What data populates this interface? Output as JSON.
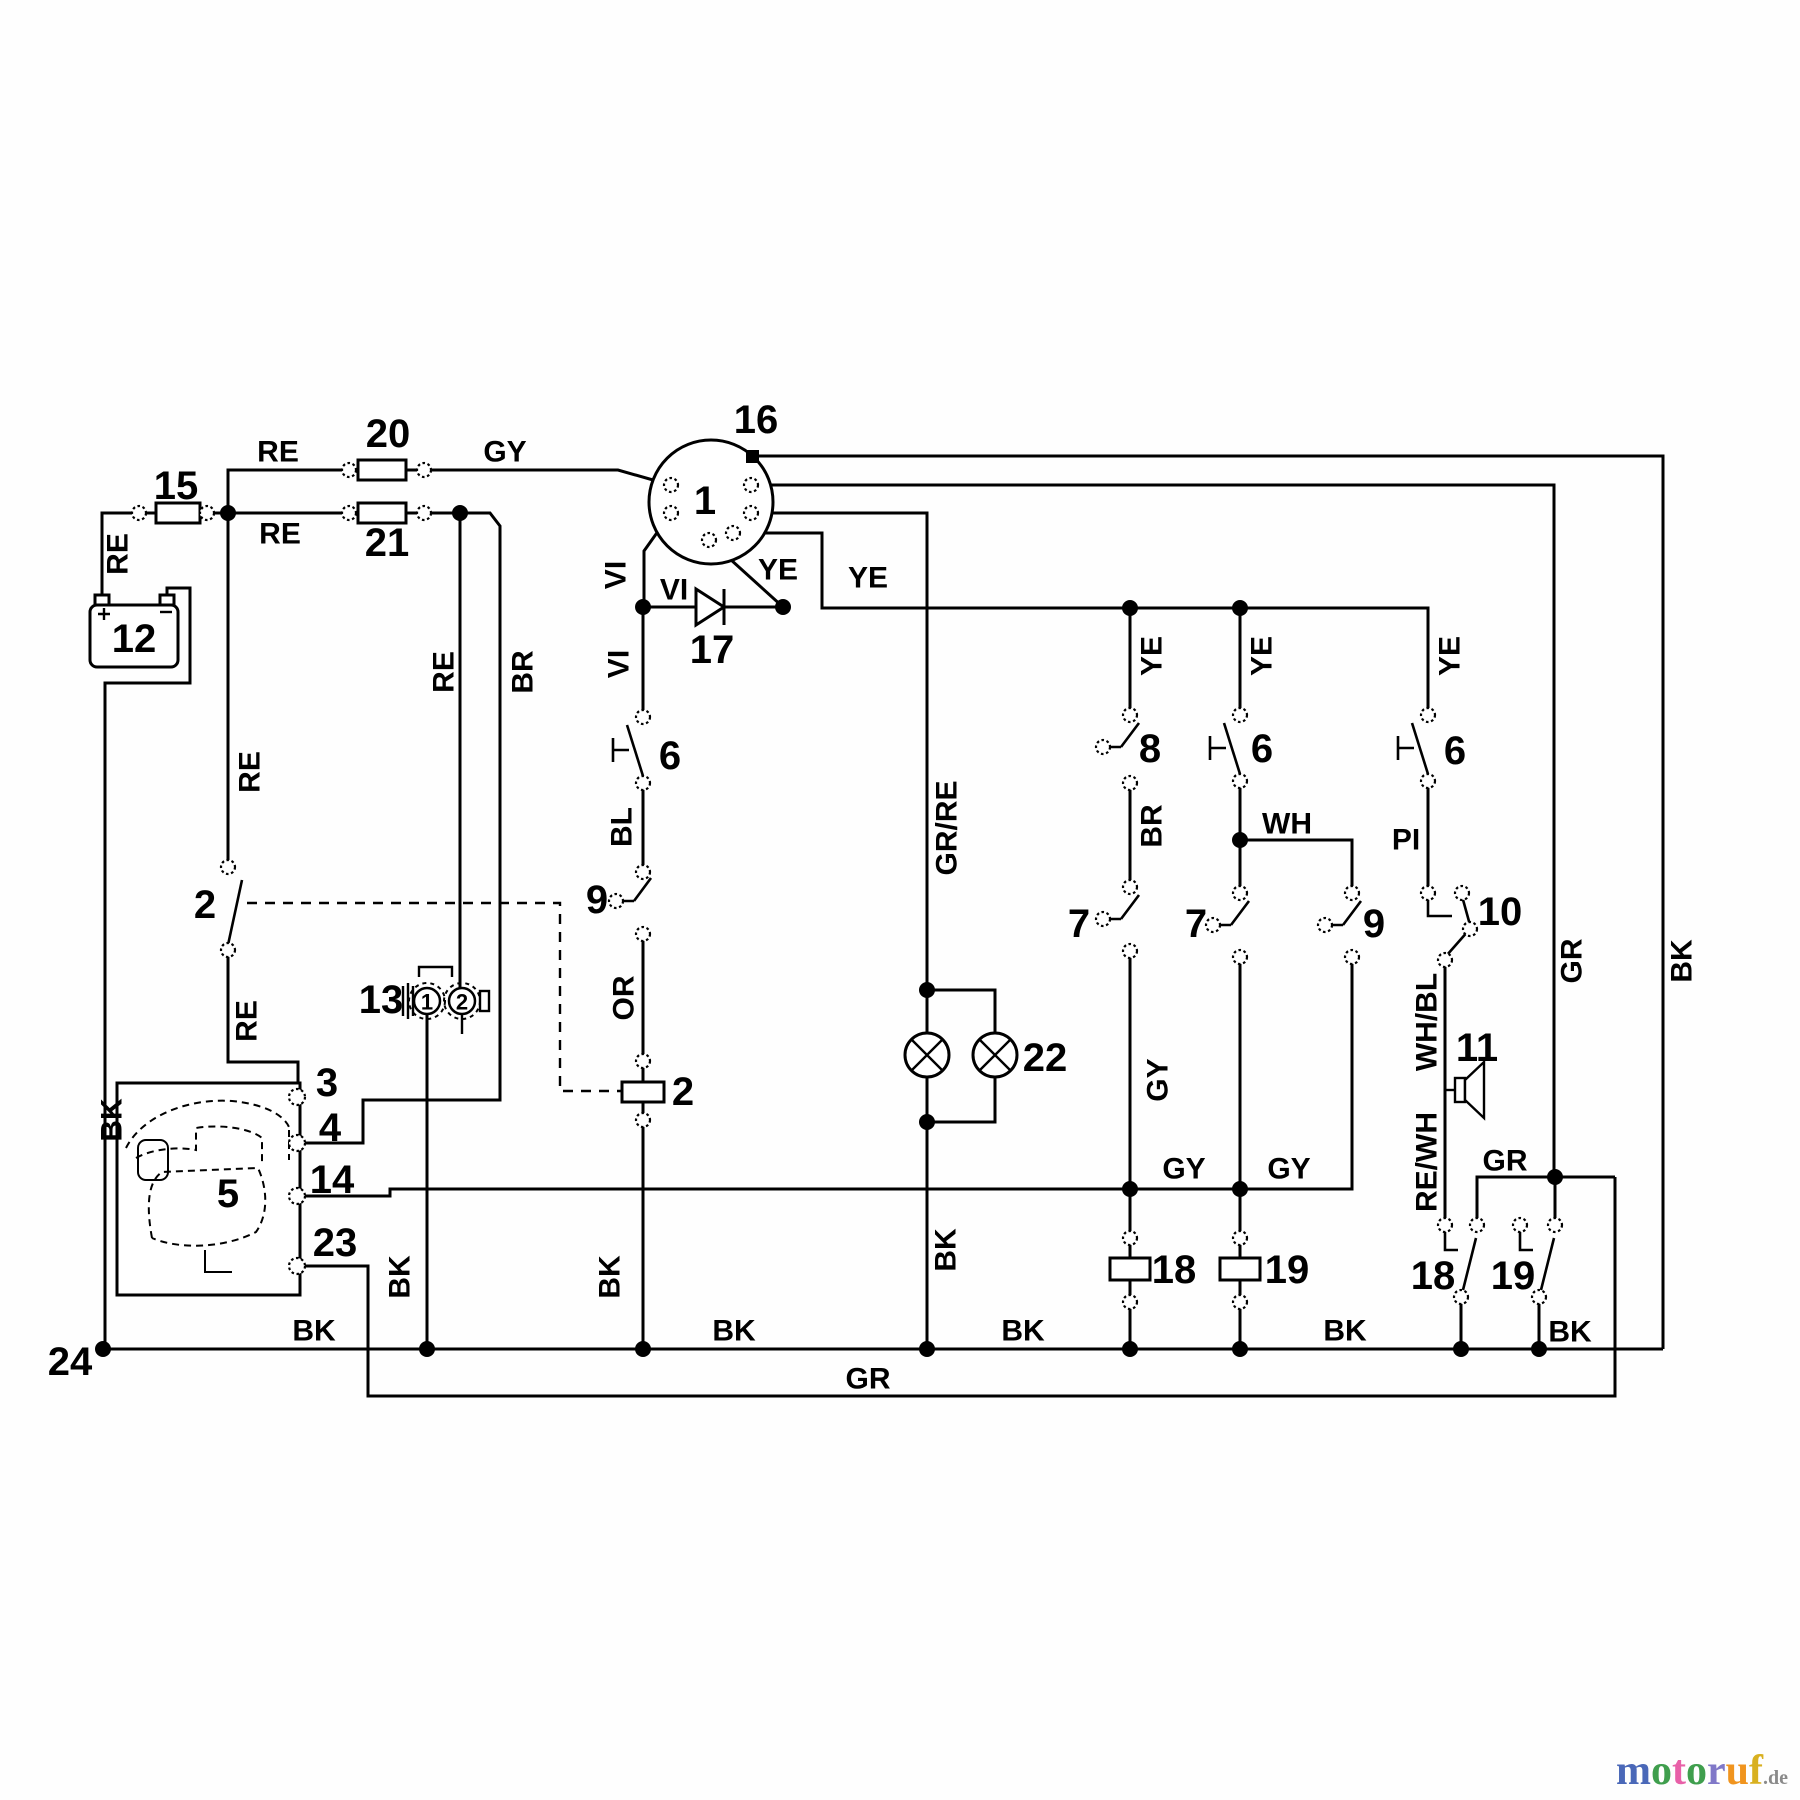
{
  "diagram": {
    "kind": "electrical wiring schematic"
  },
  "wire_labels": [
    {
      "t": "RE",
      "x": 278,
      "y": 452
    },
    {
      "t": "RE",
      "x": 280,
      "y": 534
    },
    {
      "t": "RE",
      "x": 118,
      "y": 554,
      "r": -90
    },
    {
      "t": "RE",
      "x": 250,
      "y": 772,
      "r": -90
    },
    {
      "t": "RE",
      "x": 247,
      "y": 1021,
      "r": -90
    },
    {
      "t": "RE",
      "x": 444,
      "y": 672,
      "r": -90
    },
    {
      "t": "BR",
      "x": 523,
      "y": 672,
      "r": -90
    },
    {
      "t": "GY",
      "x": 505,
      "y": 452
    },
    {
      "t": "VI",
      "x": 616,
      "y": 575,
      "r": -90
    },
    {
      "t": "VI",
      "x": 674,
      "y": 590
    },
    {
      "t": "VI",
      "x": 619,
      "y": 664,
      "r": -90
    },
    {
      "t": "YE",
      "x": 778,
      "y": 570
    },
    {
      "t": "YE",
      "x": 868,
      "y": 578
    },
    {
      "t": "YE",
      "x": 1152,
      "y": 656,
      "r": -90
    },
    {
      "t": "YE",
      "x": 1262,
      "y": 656,
      "r": -90
    },
    {
      "t": "YE",
      "x": 1450,
      "y": 656,
      "r": -90
    },
    {
      "t": "BL",
      "x": 622,
      "y": 827,
      "r": -90
    },
    {
      "t": "OR",
      "x": 624,
      "y": 998,
      "r": -90
    },
    {
      "t": "BR",
      "x": 1152,
      "y": 826,
      "r": -90
    },
    {
      "t": "WH",
      "x": 1287,
      "y": 824
    },
    {
      "t": "PI",
      "x": 1406,
      "y": 840
    },
    {
      "t": "GR/RE",
      "x": 947,
      "y": 828,
      "r": -90
    },
    {
      "t": "GY",
      "x": 1158,
      "y": 1080,
      "r": -90
    },
    {
      "t": "GY",
      "x": 1184,
      "y": 1169
    },
    {
      "t": "GY",
      "x": 1289,
      "y": 1169
    },
    {
      "t": "WH/BL",
      "x": 1427,
      "y": 1022,
      "r": -90
    },
    {
      "t": "RE/WH",
      "x": 1427,
      "y": 1162,
      "r": -90
    },
    {
      "t": "GR",
      "x": 1572,
      "y": 961,
      "r": -90
    },
    {
      "t": "BK",
      "x": 1682,
      "y": 961,
      "r": -90
    },
    {
      "t": "GR",
      "x": 1505,
      "y": 1161
    },
    {
      "t": "BK",
      "x": 112,
      "y": 1120,
      "r": -90
    },
    {
      "t": "BK",
      "x": 400,
      "y": 1277,
      "r": -90
    },
    {
      "t": "BK",
      "x": 610,
      "y": 1277,
      "r": -90
    },
    {
      "t": "BK",
      "x": 946,
      "y": 1250,
      "r": -90
    },
    {
      "t": "BK",
      "x": 314,
      "y": 1331
    },
    {
      "t": "BK",
      "x": 734,
      "y": 1331
    },
    {
      "t": "BK",
      "x": 1023,
      "y": 1331
    },
    {
      "t": "BK",
      "x": 1345,
      "y": 1331
    },
    {
      "t": "BK",
      "x": 1570,
      "y": 1332
    },
    {
      "t": "GR",
      "x": 868,
      "y": 1379
    }
  ],
  "component_labels": [
    {
      "t": "15",
      "x": 176,
      "y": 486
    },
    {
      "t": "20",
      "x": 388,
      "y": 434
    },
    {
      "t": "21",
      "x": 387,
      "y": 543
    },
    {
      "t": "12",
      "x": 134,
      "y": 639
    },
    {
      "t": "16",
      "x": 756,
      "y": 420
    },
    {
      "t": "1",
      "x": 705,
      "y": 501
    },
    {
      "t": "17",
      "x": 712,
      "y": 650
    },
    {
      "t": "2",
      "x": 205,
      "y": 905
    },
    {
      "t": "13",
      "x": 381,
      "y": 1000
    },
    {
      "t": "1",
      "x": 427,
      "y": 1002,
      "s": 22
    },
    {
      "t": "2",
      "x": 462,
      "y": 1002,
      "s": 22
    },
    {
      "t": "3",
      "x": 327,
      "y": 1083
    },
    {
      "t": "4",
      "x": 330,
      "y": 1128
    },
    {
      "t": "14",
      "x": 332,
      "y": 1180
    },
    {
      "t": "23",
      "x": 335,
      "y": 1243
    },
    {
      "t": "5",
      "x": 228,
      "y": 1194
    },
    {
      "t": "6",
      "x": 670,
      "y": 756
    },
    {
      "t": "9",
      "x": 597,
      "y": 900
    },
    {
      "t": "2",
      "x": 683,
      "y": 1092
    },
    {
      "t": "8",
      "x": 1150,
      "y": 749
    },
    {
      "t": "6",
      "x": 1262,
      "y": 749
    },
    {
      "t": "6",
      "x": 1455,
      "y": 751
    },
    {
      "t": "7",
      "x": 1079,
      "y": 924
    },
    {
      "t": "7",
      "x": 1196,
      "y": 924
    },
    {
      "t": "9",
      "x": 1374,
      "y": 924
    },
    {
      "t": "10",
      "x": 1500,
      "y": 912
    },
    {
      "t": "11",
      "x": 1477,
      "y": 1048
    },
    {
      "t": "22",
      "x": 1045,
      "y": 1058
    },
    {
      "t": "18",
      "x": 1174,
      "y": 1270
    },
    {
      "t": "19",
      "x": 1287,
      "y": 1270
    },
    {
      "t": "18",
      "x": 1433,
      "y": 1276
    },
    {
      "t": "19",
      "x": 1513,
      "y": 1276
    },
    {
      "t": "24",
      "x": 70,
      "y": 1362
    }
  ],
  "watermark": {
    "letters": [
      {
        "ch": "m",
        "color": "#4a68b8"
      },
      {
        "ch": "o",
        "color": "#3f9e4d"
      },
      {
        "ch": "t",
        "color": "#e860a8"
      },
      {
        "ch": "o",
        "color": "#3f9e4d"
      },
      {
        "ch": "r",
        "color": "#8078c8"
      },
      {
        "ch": "u",
        "color": "#f0941e"
      },
      {
        "ch": "f",
        "color": "#d8b020"
      }
    ],
    "suffix": ".de"
  }
}
